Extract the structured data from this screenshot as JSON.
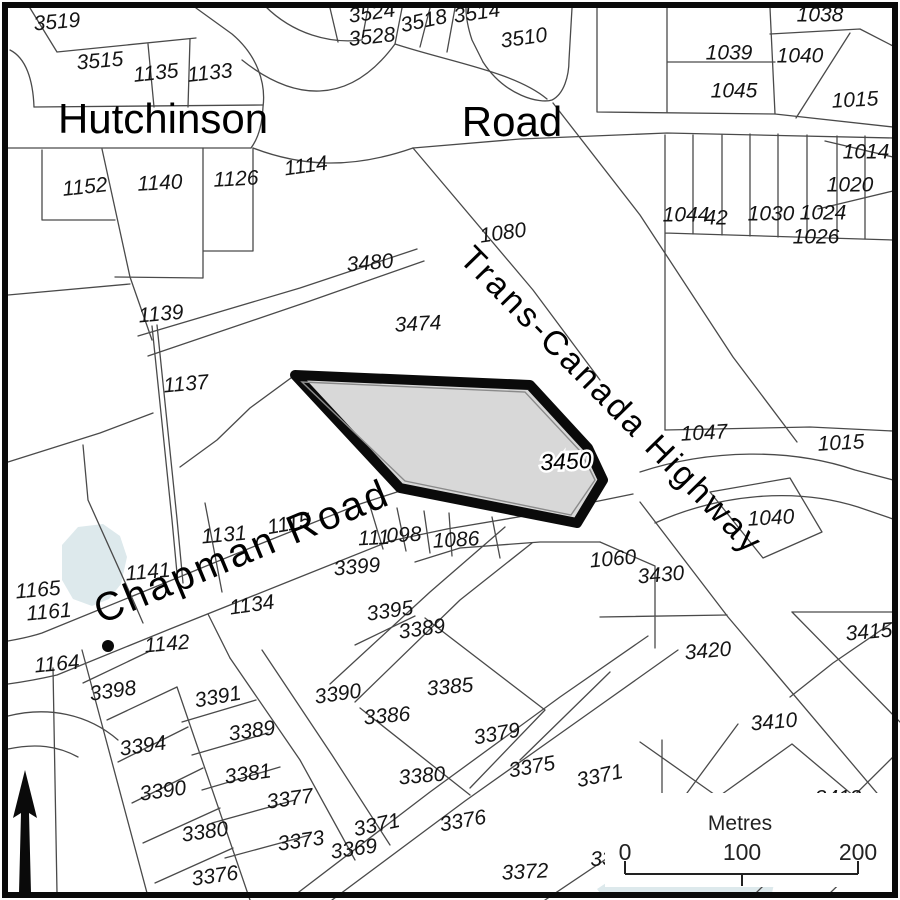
{
  "map": {
    "title": "Parcel map",
    "colors": {
      "highlight_fill": "#d8d8d8",
      "highlight_border": "#0a0a0a",
      "pond_fill": "#dde9ec",
      "line": "#4a4a4a"
    },
    "road_labels": [
      {
        "text": "Hutchinson",
        "x": 163,
        "y": 122,
        "size": 42,
        "rot": 0,
        "spacing": 0
      },
      {
        "text": "Road",
        "x": 512,
        "y": 125,
        "size": 42,
        "rot": 0,
        "spacing": 0
      },
      {
        "text": "Trans-Canada Highway",
        "x": 610,
        "y": 402,
        "size": 34,
        "rot": 45.5,
        "spacing": 3
      },
      {
        "text": "Chapman Road",
        "x": 243,
        "y": 554,
        "size": 40,
        "rot": -22.5,
        "spacing": 3
      }
    ],
    "highlight_label": {
      "text": "3450",
      "x": 566,
      "y": 463,
      "rot": -3,
      "size": 23
    },
    "parcel_labels": [
      {
        "text": "3519",
        "x": 57,
        "y": 23,
        "rot": -5
      },
      {
        "text": "3515",
        "x": 100,
        "y": 62,
        "rot": -5
      },
      {
        "text": "1135",
        "x": 156,
        "y": 74,
        "rot": -6
      },
      {
        "text": "1133",
        "x": 210,
        "y": 74,
        "rot": -6
      },
      {
        "text": "3524",
        "x": 372,
        "y": 14,
        "rot": -8
      },
      {
        "text": "3528",
        "x": 372,
        "y": 38,
        "rot": -6
      },
      {
        "text": "3518",
        "x": 424,
        "y": 22,
        "rot": -12
      },
      {
        "text": "3514",
        "x": 477,
        "y": 14,
        "rot": -8
      },
      {
        "text": "3510",
        "x": 524,
        "y": 39,
        "rot": -8
      },
      {
        "text": "1038",
        "x": 820,
        "y": 16,
        "rot": 0
      },
      {
        "text": "1039",
        "x": 729,
        "y": 54,
        "rot": 0
      },
      {
        "text": "1040",
        "x": 800,
        "y": 57,
        "rot": 0
      },
      {
        "text": "1045",
        "x": 734,
        "y": 92,
        "rot": 0
      },
      {
        "text": "1015",
        "x": 855,
        "y": 101,
        "rot": -3
      },
      {
        "text": "1152",
        "x": 85,
        "y": 188,
        "rot": -6
      },
      {
        "text": "1140",
        "x": 160,
        "y": 184,
        "rot": -3
      },
      {
        "text": "1126",
        "x": 236,
        "y": 180,
        "rot": -3
      },
      {
        "text": "1114",
        "x": 306,
        "y": 167,
        "rot": -8
      },
      {
        "text": "1014",
        "x": 866,
        "y": 153,
        "rot": 0
      },
      {
        "text": "1020",
        "x": 850,
        "y": 186,
        "rot": 0
      },
      {
        "text": "1044",
        "x": 686,
        "y": 216,
        "rot": 0
      },
      {
        "text": "42",
        "x": 716,
        "y": 219,
        "rot": 0
      },
      {
        "text": "1030",
        "x": 771,
        "y": 215,
        "rot": 0
      },
      {
        "text": "1024",
        "x": 823,
        "y": 214,
        "rot": 0
      },
      {
        "text": "1026",
        "x": 816,
        "y": 238,
        "rot": 0
      },
      {
        "text": "1080",
        "x": 503,
        "y": 234,
        "rot": -8
      },
      {
        "text": "3480",
        "x": 370,
        "y": 264,
        "rot": -5
      },
      {
        "text": "1139",
        "x": 161,
        "y": 315,
        "rot": -5
      },
      {
        "text": "3474",
        "x": 418,
        "y": 325,
        "rot": -3
      },
      {
        "text": "1137",
        "x": 186,
        "y": 385,
        "rot": -5
      },
      {
        "text": "1047",
        "x": 704,
        "y": 434,
        "rot": -3
      },
      {
        "text": "1015",
        "x": 841,
        "y": 444,
        "rot": -3
      },
      {
        "text": "1040",
        "x": 771,
        "y": 519,
        "rot": -3
      },
      {
        "text": "1115",
        "x": 289,
        "y": 525,
        "rot": -10
      },
      {
        "text": "1131",
        "x": 224,
        "y": 536,
        "rot": -5
      },
      {
        "text": "111",
        "x": 374,
        "y": 539,
        "rot": -3
      },
      {
        "text": "098",
        "x": 404,
        "y": 536,
        "rot": -3
      },
      {
        "text": "1086",
        "x": 456,
        "y": 541,
        "rot": -3
      },
      {
        "text": "3399",
        "x": 357,
        "y": 568,
        "rot": -5
      },
      {
        "text": "1141",
        "x": 148,
        "y": 573,
        "rot": -5
      },
      {
        "text": "1060",
        "x": 613,
        "y": 560,
        "rot": -5
      },
      {
        "text": "3430",
        "x": 661,
        "y": 576,
        "rot": -5
      },
      {
        "text": "1165",
        "x": 38,
        "y": 591,
        "rot": -5
      },
      {
        "text": "1161",
        "x": 49,
        "y": 613,
        "rot": -5
      },
      {
        "text": "1134",
        "x": 252,
        "y": 606,
        "rot": -8
      },
      {
        "text": "3395",
        "x": 390,
        "y": 612,
        "rot": -8
      },
      {
        "text": "3389",
        "x": 422,
        "y": 630,
        "rot": -8
      },
      {
        "text": "1142",
        "x": 167,
        "y": 645,
        "rot": -5
      },
      {
        "text": "3415",
        "x": 869,
        "y": 633,
        "rot": -5
      },
      {
        "text": "1164",
        "x": 57,
        "y": 665,
        "rot": -5
      },
      {
        "text": "3420",
        "x": 708,
        "y": 652,
        "rot": -5
      },
      {
        "text": "3398",
        "x": 113,
        "y": 692,
        "rot": -8
      },
      {
        "text": "3391",
        "x": 218,
        "y": 698,
        "rot": -10
      },
      {
        "text": "3390",
        "x": 338,
        "y": 695,
        "rot": -8
      },
      {
        "text": "3386",
        "x": 387,
        "y": 717,
        "rot": -5
      },
      {
        "text": "3385",
        "x": 450,
        "y": 688,
        "rot": -5
      },
      {
        "text": "3389",
        "x": 252,
        "y": 732,
        "rot": -8
      },
      {
        "text": "3379",
        "x": 497,
        "y": 735,
        "rot": -10
      },
      {
        "text": "3410",
        "x": 774,
        "y": 723,
        "rot": -5
      },
      {
        "text": "3394",
        "x": 143,
        "y": 747,
        "rot": -8
      },
      {
        "text": "3381",
        "x": 248,
        "y": 775,
        "rot": -8
      },
      {
        "text": "3375",
        "x": 532,
        "y": 768,
        "rot": -10
      },
      {
        "text": "3371",
        "x": 600,
        "y": 777,
        "rot": -12
      },
      {
        "text": "3390",
        "x": 163,
        "y": 792,
        "rot": -8
      },
      {
        "text": "3377",
        "x": 290,
        "y": 800,
        "rot": -8
      },
      {
        "text": "3380",
        "x": 422,
        "y": 777,
        "rot": -5
      },
      {
        "text": "3380",
        "x": 205,
        "y": 833,
        "rot": -8
      },
      {
        "text": "3373",
        "x": 301,
        "y": 842,
        "rot": -8
      },
      {
        "text": "3371",
        "x": 377,
        "y": 826,
        "rot": -12
      },
      {
        "text": "3369",
        "x": 354,
        "y": 850,
        "rot": -8
      },
      {
        "text": "3376",
        "x": 463,
        "y": 822,
        "rot": -10
      },
      {
        "text": "3376",
        "x": 215,
        "y": 877,
        "rot": -8
      },
      {
        "text": "3372",
        "x": 525,
        "y": 873,
        "rot": -3
      },
      {
        "text": "33",
        "x": 602,
        "y": 860,
        "rot": -3
      },
      {
        "text": "3412",
        "x": 838,
        "y": 799,
        "rot": 0
      }
    ],
    "scale_bar": {
      "title": "Metres",
      "ticks": [
        "0",
        "100",
        "200"
      ]
    }
  }
}
